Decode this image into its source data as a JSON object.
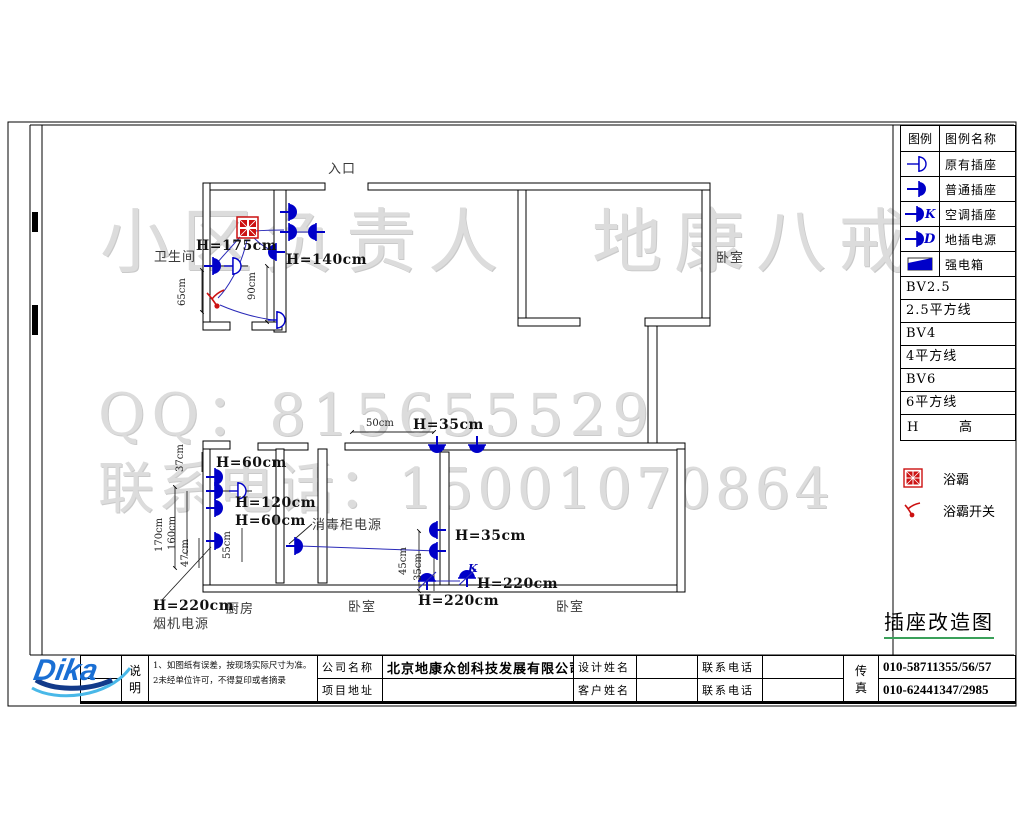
{
  "watermarks": {
    "line1": "小区负责人　地康八戒",
    "line2": "QQ：815655529",
    "line3": "联系电话：15001070864"
  },
  "drawing_title": "插座改造图",
  "legend": {
    "header": {
      "col1": "图例",
      "col2": "图例名称"
    },
    "rows": [
      {
        "icon": "existing-socket",
        "label": "原有插座"
      },
      {
        "icon": "normal-socket",
        "label": "普通插座"
      },
      {
        "icon": "ac-socket",
        "label": "空调插座"
      },
      {
        "icon": "floor-socket-power",
        "label": "地插电源"
      },
      {
        "icon": "power-distribution-box",
        "label": "强电箱"
      }
    ],
    "wire_rows": [
      "BV2.5",
      "2.5平方线",
      "BV4",
      "4平方线",
      "BV6",
      "6平方线"
    ],
    "h_row": {
      "symbol": "H",
      "label": "高"
    },
    "extra": [
      {
        "icon": "bath-heater",
        "label": "浴霸"
      },
      {
        "icon": "bath-heater-switch",
        "label": "浴霸开关"
      }
    ]
  },
  "plan": {
    "labels": [
      {
        "t": "入口",
        "x": 328,
        "y": 158,
        "cls": "room",
        "name": "room-label-entrance"
      },
      {
        "t": "卫生间",
        "x": 154,
        "y": 246,
        "cls": "room",
        "name": "room-label-bathroom"
      },
      {
        "t": "卧室",
        "x": 716,
        "y": 247,
        "cls": "room",
        "name": "room-label-bedroom-1"
      },
      {
        "t": "厨房",
        "x": 226,
        "y": 598,
        "cls": "room",
        "name": "room-label-kitchen"
      },
      {
        "t": "卧室",
        "x": 348,
        "y": 596,
        "cls": "room",
        "name": "room-label-bedroom-2"
      },
      {
        "t": "卧室",
        "x": 556,
        "y": 596,
        "cls": "room",
        "name": "room-label-bedroom-3"
      },
      {
        "t": "H=175cm",
        "x": 196,
        "y": 238,
        "cls": "hl",
        "name": "height-label"
      },
      {
        "t": "H=140cm",
        "x": 286,
        "y": 252,
        "cls": "hl",
        "name": "height-label"
      },
      {
        "t": "H=60cm",
        "x": 216,
        "y": 455,
        "cls": "hl",
        "name": "height-label"
      },
      {
        "t": "H=120cm",
        "x": 235,
        "y": 495,
        "cls": "hl",
        "name": "height-label"
      },
      {
        "t": "H=60cm",
        "x": 235,
        "y": 513,
        "cls": "hl",
        "name": "height-label"
      },
      {
        "t": "消毒柜电源",
        "x": 312,
        "y": 514,
        "cls": "room",
        "name": "appliance-label-sterilizer"
      },
      {
        "t": "H=35cm",
        "x": 413,
        "y": 417,
        "cls": "hl",
        "name": "height-label"
      },
      {
        "t": "H=35cm",
        "x": 455,
        "y": 528,
        "cls": "hl",
        "name": "height-label"
      },
      {
        "t": "H=220cm",
        "x": 477,
        "y": 576,
        "cls": "hl",
        "name": "height-label"
      },
      {
        "t": "H=220cm",
        "x": 418,
        "y": 593,
        "cls": "hl",
        "name": "height-label"
      },
      {
        "t": "H=220cm",
        "x": 153,
        "y": 598,
        "cls": "hl",
        "name": "height-label"
      },
      {
        "t": "烟机电源",
        "x": 153,
        "y": 613,
        "cls": "room",
        "name": "appliance-label-hood"
      },
      {
        "t": "K",
        "x": 468,
        "y": 562,
        "cls": "kletter",
        "name": "ac-socket-letter"
      },
      {
        "t": "50cm",
        "x": 366,
        "y": 418,
        "cls": "dim",
        "name": "dim-label"
      },
      {
        "t": "65cm",
        "x": 188,
        "y": 295,
        "cls": "dim",
        "rot": true,
        "name": "dim-label"
      },
      {
        "t": "90cm",
        "x": 258,
        "y": 289,
        "cls": "dim",
        "rot": true,
        "name": "dim-label"
      },
      {
        "t": "37cm",
        "x": 186,
        "y": 461,
        "cls": "dim",
        "rot": true,
        "name": "dim-label"
      },
      {
        "t": "170cm",
        "x": 165,
        "y": 541,
        "cls": "dim",
        "rot": true,
        "name": "dim-label"
      },
      {
        "t": "160cm",
        "x": 178,
        "y": 539,
        "cls": "dim",
        "rot": true,
        "name": "dim-label"
      },
      {
        "t": "47cm",
        "x": 191,
        "y": 556,
        "cls": "dim",
        "rot": true,
        "name": "dim-label"
      },
      {
        "t": "55cm",
        "x": 233,
        "y": 548,
        "cls": "dim",
        "rot": true,
        "name": "dim-label"
      },
      {
        "t": "45cm",
        "x": 409,
        "y": 564,
        "cls": "dim",
        "rot": true,
        "name": "dim-label"
      },
      {
        "t": "35cm",
        "x": 424,
        "y": 570,
        "cls": "dim",
        "rot": true,
        "name": "dim-label"
      }
    ]
  },
  "titleblock": {
    "logo_text": "Dika",
    "note_label_top": "说",
    "note_label_bottom": "明",
    "note1": "1、如图纸有误差，按现场实际尺寸为准。",
    "note2": "2未经单位许可，不得复印或者摘录",
    "company_label": "公司名称",
    "company_value": "北京地康众创科技发展有限公司",
    "address_label": "项目地址",
    "address_value": "",
    "designer_label": "设计姓名",
    "designer_value": "",
    "customer_label": "客户姓名",
    "customer_value": "",
    "phone_label_1": "联系电话",
    "phone_value_1": "",
    "phone_label_2": "联系电话",
    "phone_value_2": "",
    "fax_label_top": "传",
    "fax_label_bottom": "真",
    "fax_value_1": "010-58711355/56/57",
    "fax_value_2": "010-62441347/2985"
  }
}
